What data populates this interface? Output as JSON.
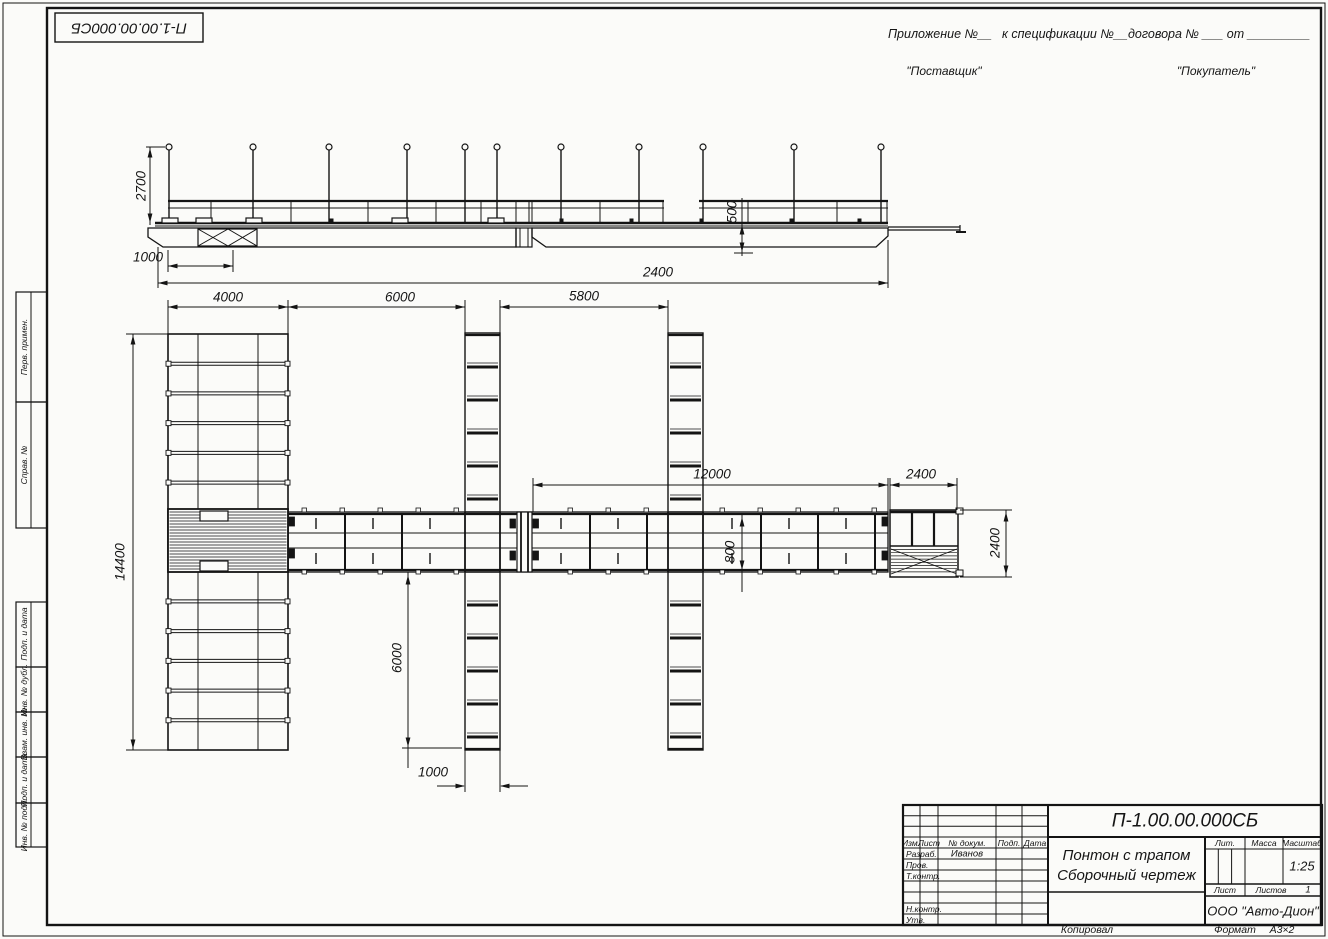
{
  "page": {
    "stamp_doc_number": "П-1.00.00.000СБ",
    "copied_label": "Копировал",
    "format_label": "Формат",
    "format_value": "А3×2"
  },
  "header": {
    "appendix_part1": "Приложение №__",
    "appendix_part2": "к спецификации №__",
    "appendix_part3": "договора № ___  от _________",
    "supplier": "\"Поставщик\"",
    "buyer": "\"Покупатель\""
  },
  "margin_fields": {
    "perv_primen": "Перв. примен.",
    "sprav_no": "Справ. №",
    "podp_data_1": "Подп. и дата",
    "inv_dubl": "Инв. № дубл.",
    "vzam_inv": "Взам. инв. №",
    "podp_data_2": "Подп. и дата",
    "inv_podl": "Инв. № подл."
  },
  "dimensions": {
    "side_mast_height": "2700",
    "side_left_offset": "1000",
    "side_freeboard": "500",
    "side_overall": "2400",
    "plan_left_module_width": "4000",
    "plan_gap_1": "6000",
    "plan_gap_2": "5800",
    "plan_walkway_length": "12000",
    "plan_ramp_width": "2400",
    "plan_left_module_height": "14400",
    "plan_walkway_width": "800",
    "plan_finger_length": "6000",
    "plan_finger_width": "1000",
    "plan_ramp_height": "2400"
  },
  "title_block": {
    "doc_number": "П-1.00.00.000СБ",
    "title_line1": "Понтон с трапом",
    "title_line2": "Сборочный чертеж",
    "company": "ООО \"Авто-Дион\"",
    "scale_value": "1:25",
    "sheets_value": "1",
    "developer_name": "Иванов",
    "labels": {
      "izm": "Изм.",
      "list": "Лист",
      "n_dokum": "№ докум.",
      "podp": "Подп.",
      "data": "Дата",
      "razrab": "Разраб.",
      "prov": "Пров.",
      "t_kontr": "Т.контр.",
      "n_kontr": "Н.контр.",
      "utv": "Утв.",
      "lit": "Лит.",
      "massa": "Масса",
      "masshtab": "Масштаб",
      "list2": "Лист",
      "listov": "Листов"
    }
  }
}
